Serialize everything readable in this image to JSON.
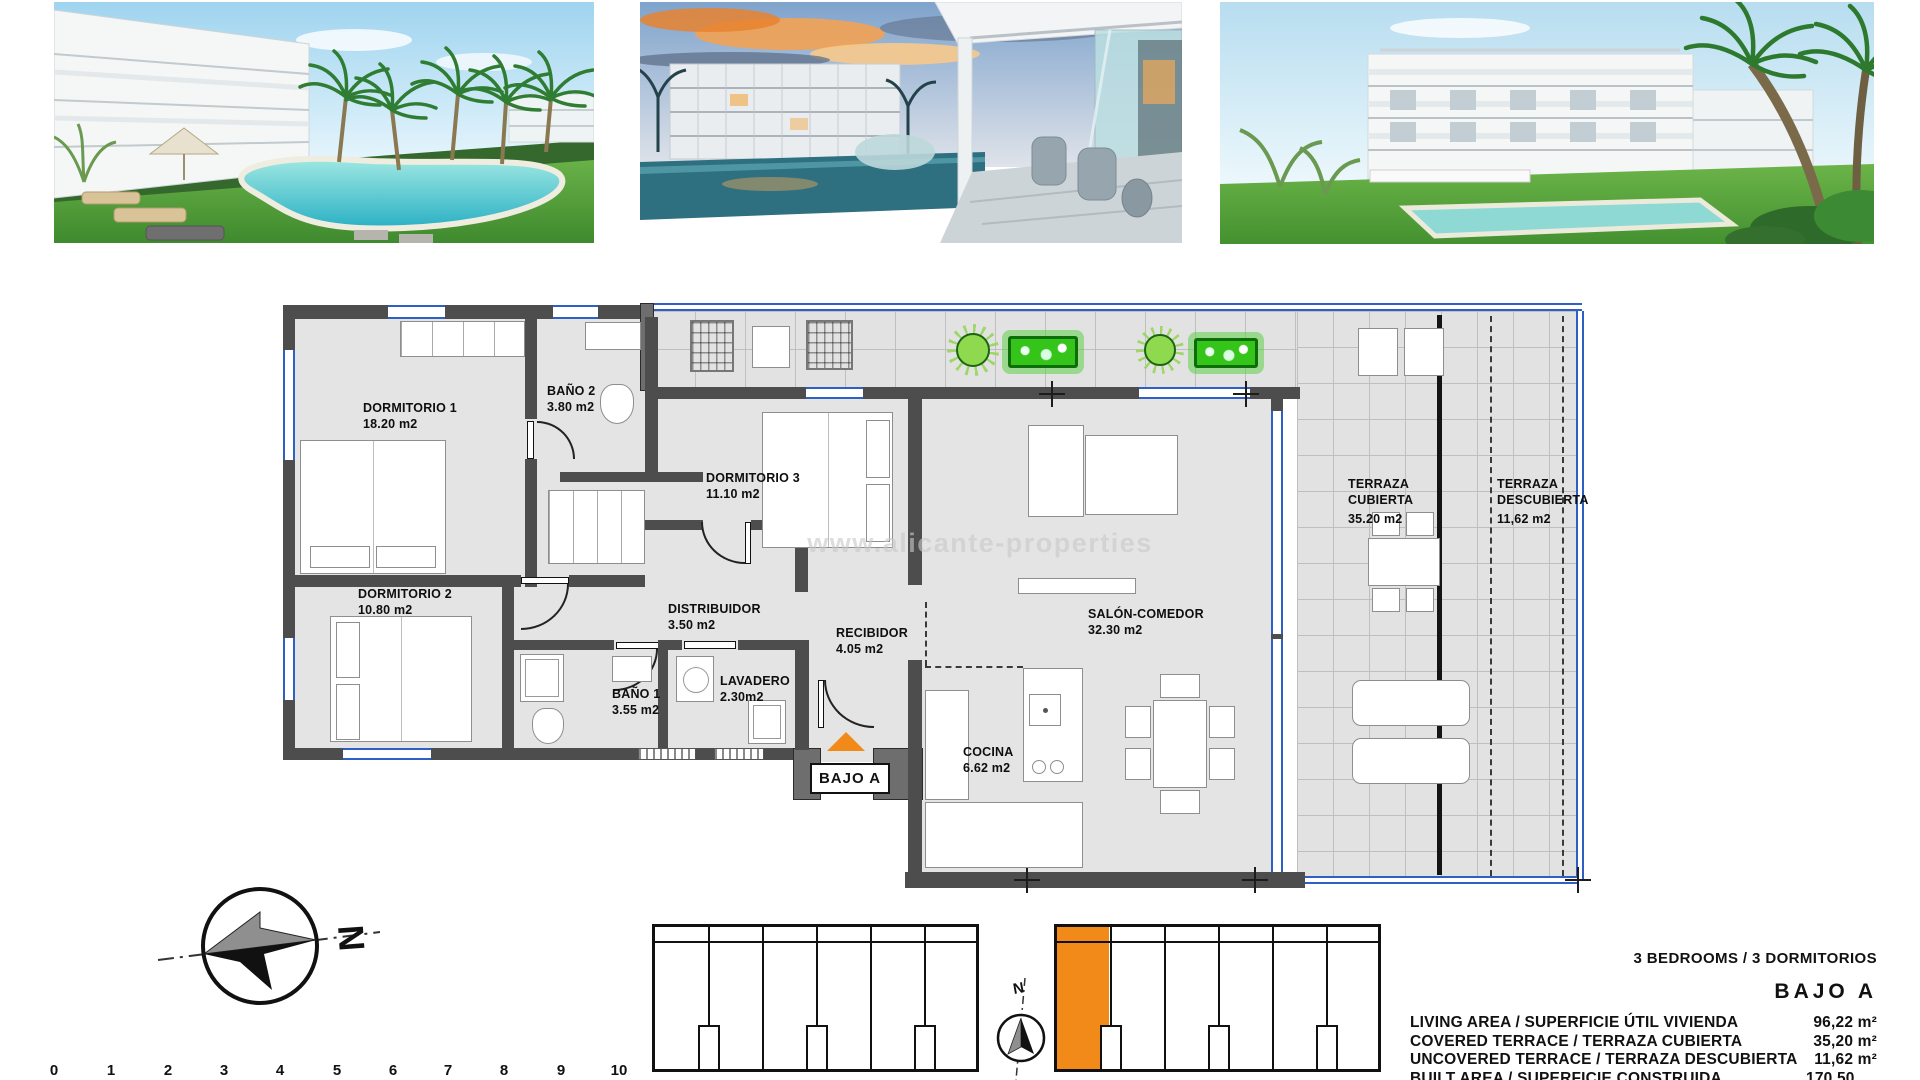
{
  "floor_plan": {
    "watermark": "www.alicante-properties",
    "entrance": {
      "label": "BAJO A"
    },
    "rooms": [
      {
        "id": "dormitorio-1",
        "name": "DORMITORIO 1",
        "area": "18.20 m2"
      },
      {
        "id": "bano-2",
        "name": "BAÑO 2",
        "area": "3.80 m2"
      },
      {
        "id": "dormitorio-3",
        "name": "DORMITORIO 3",
        "area": "11.10 m2"
      },
      {
        "id": "dormitorio-2",
        "name": "DORMITORIO 2",
        "area": "10.80 m2"
      },
      {
        "id": "distribuidor",
        "name": "DISTRIBUIDOR",
        "area": "3.50 m2"
      },
      {
        "id": "bano-1",
        "name": "BAÑO 1",
        "area": "3.55 m2"
      },
      {
        "id": "lavadero",
        "name": "LAVADERO",
        "area": "2.30m2"
      },
      {
        "id": "recibidor",
        "name": "RECIBIDOR",
        "area": "4.05 m2"
      },
      {
        "id": "cocina",
        "name": "COCINA",
        "area": "6.62 m2"
      },
      {
        "id": "salon-comedor",
        "name": "SALÓN-COMEDOR",
        "area": "32.30 m2"
      },
      {
        "id": "terraza-cubierta",
        "name": "TERRAZA CUBIERTA",
        "area": "35.20 m2"
      },
      {
        "id": "terraza-descubierta",
        "name": "TERRAZA DESCUBIERTA",
        "area": "11,62 m2"
      }
    ]
  },
  "compass": {
    "north_label": "N"
  },
  "key_plan": {
    "north_label": "N"
  },
  "scale_bar": {
    "ticks": [
      "0",
      "1",
      "2",
      "3",
      "4",
      "5",
      "6",
      "7",
      "8",
      "9",
      "10"
    ]
  },
  "summary": {
    "type_line": "3 BEDROOMS / 3 DORMITORIOS",
    "unit": "BAJO A",
    "rows": [
      {
        "label": "LIVING AREA / SUPERFICIE ÚTIL VIVIENDA",
        "value": "96,22 m²"
      },
      {
        "label": "COVERED TERRACE / TERRAZA CUBIERTA",
        "value": "35,20 m²"
      },
      {
        "label": "UNCOVERED TERRACE / TERRAZA DESCUBIERTA",
        "value": "11,62 m²"
      },
      {
        "label": "BUILT AREA / SUPERFICIE CONSTRUIDA PROYECTO",
        "value": "170,50 m²"
      }
    ]
  },
  "colors": {
    "accent_orange": "#F28A1A",
    "plan_blue": "#2E5FC4",
    "plant_green": "#35C419"
  }
}
